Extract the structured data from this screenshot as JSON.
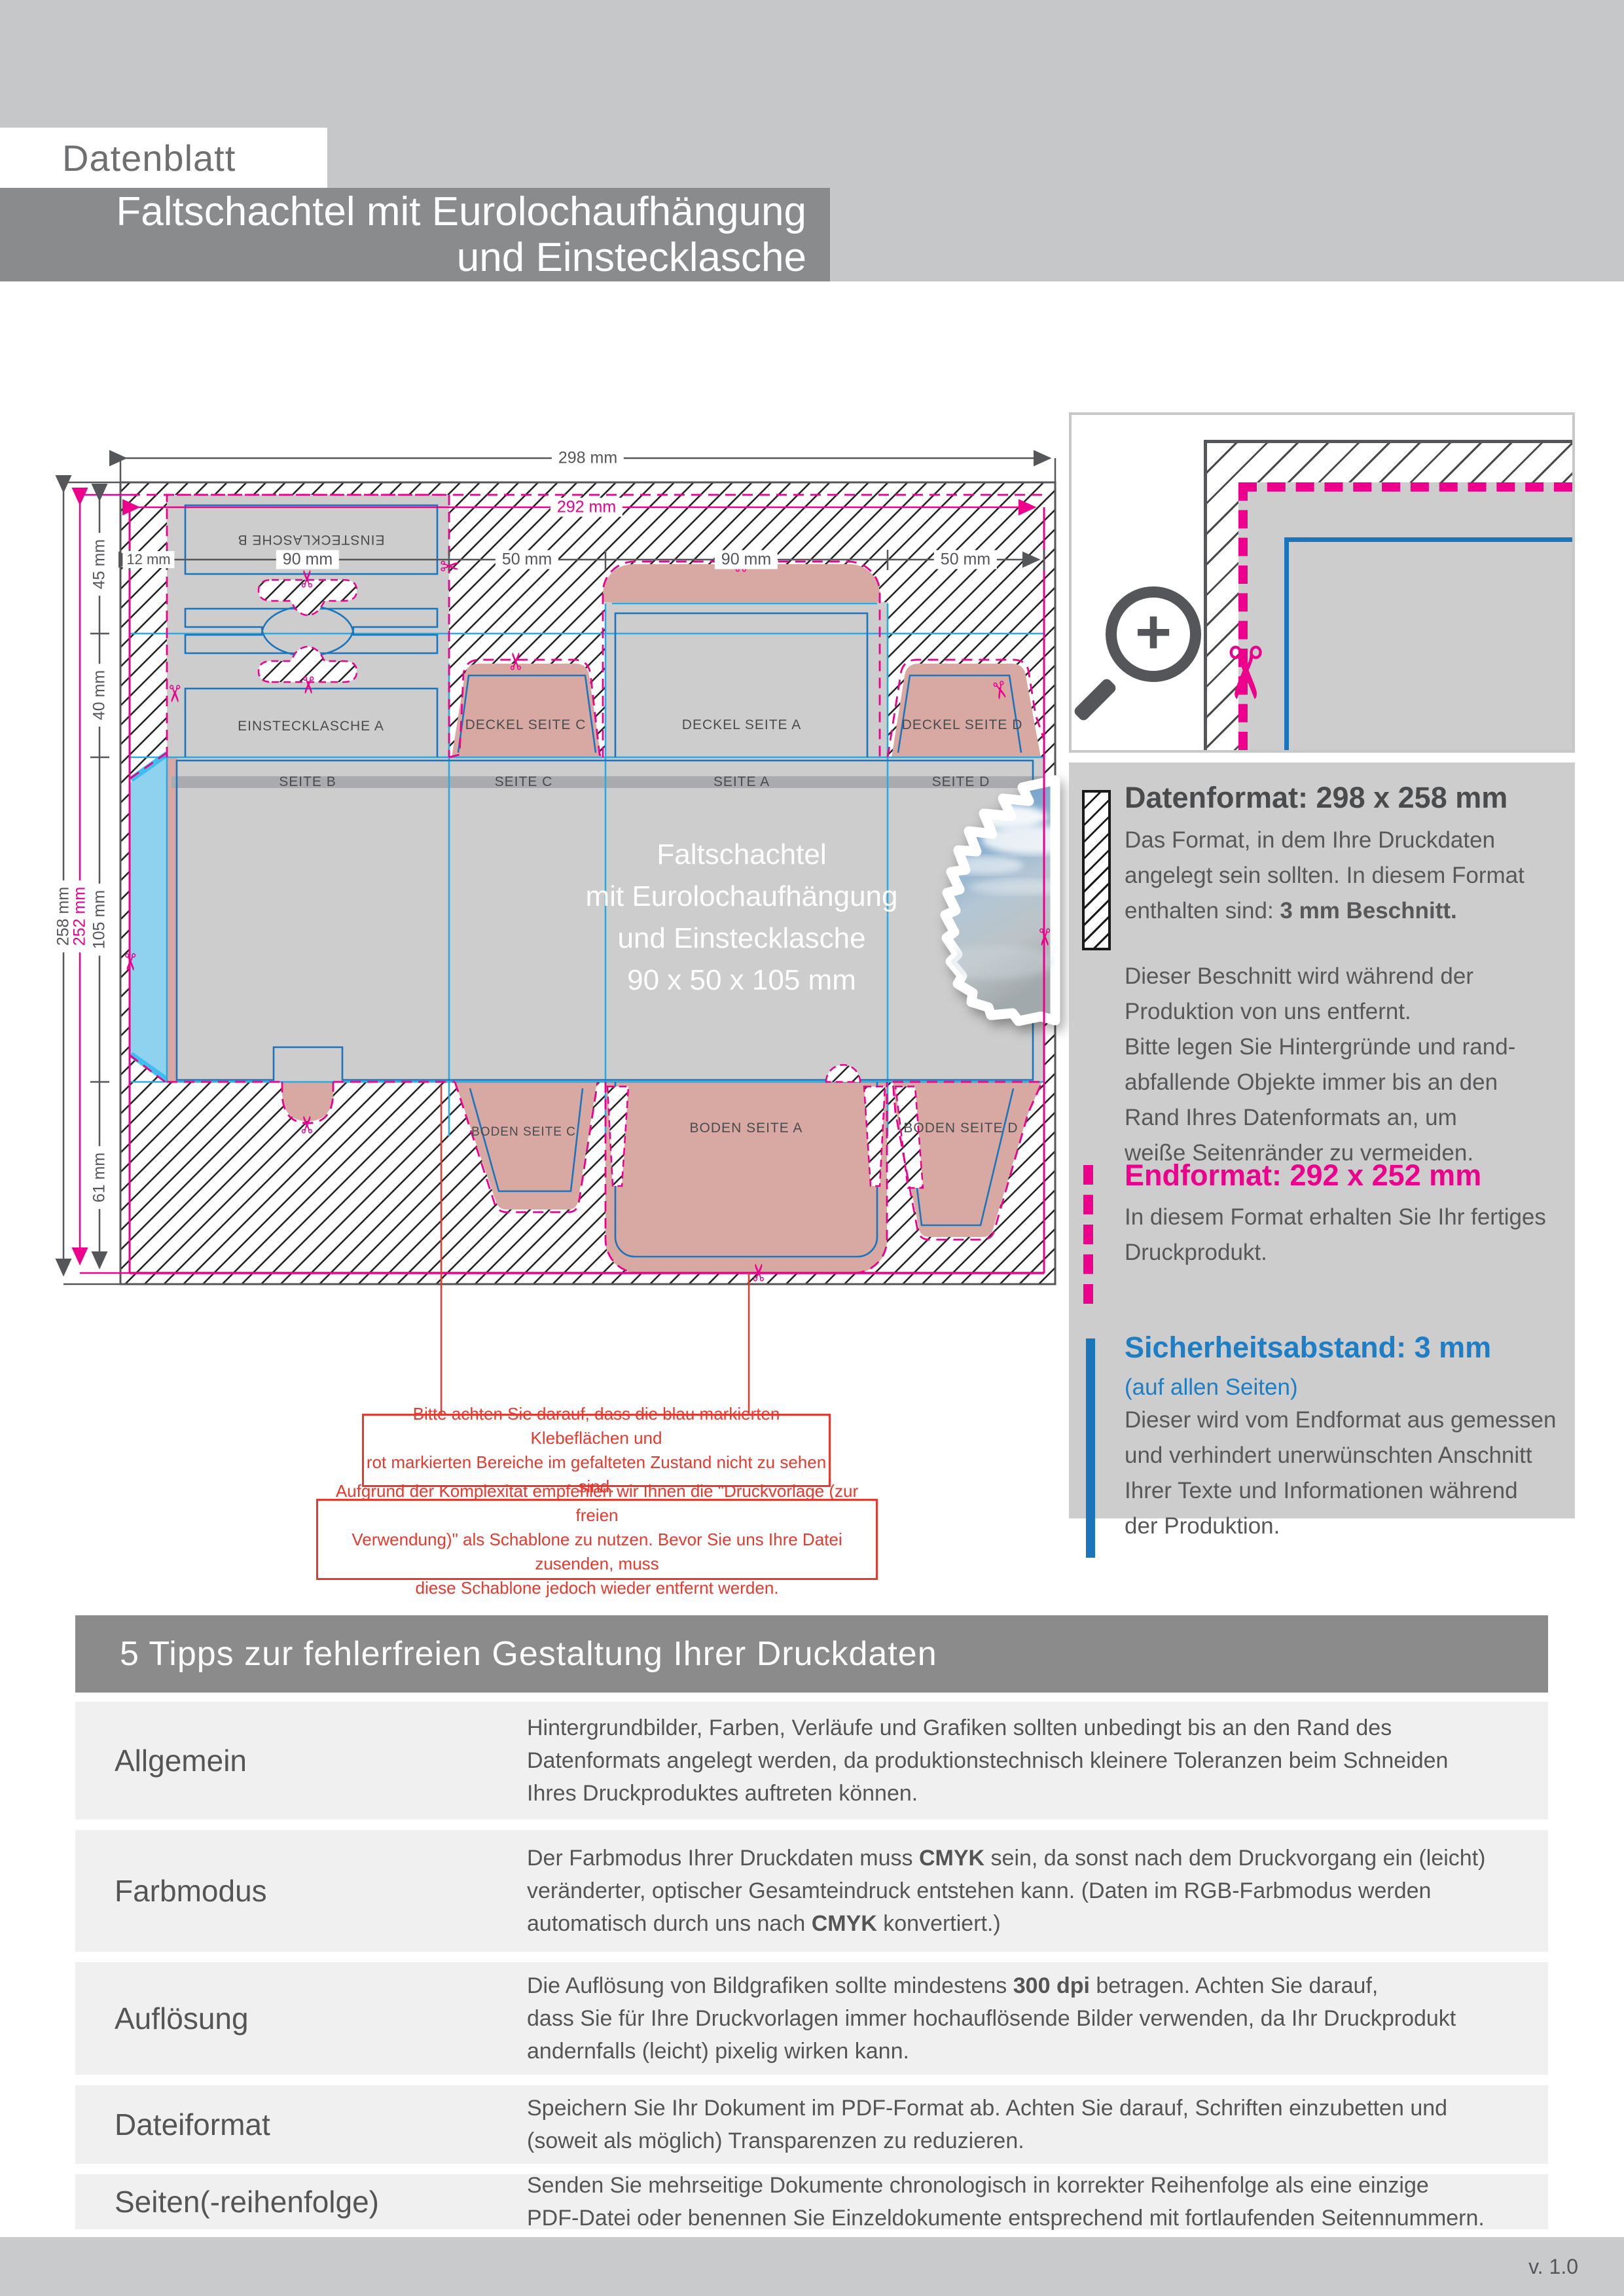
{
  "header": {
    "sheet_label": "Datenblatt",
    "title": "Faltschachtel mit Eurolochaufhängung\nund Einstecklasche"
  },
  "diagram": {
    "dims_top": {
      "outer": "298 mm",
      "inner": "292 mm",
      "segments": [
        "12 mm",
        "90 mm",
        "50 mm",
        "90 mm",
        "50 mm"
      ]
    },
    "dims_left": {
      "outer": "258 mm",
      "inner": "252 mm",
      "segments": [
        "45 mm",
        "40 mm",
        "105 mm",
        "61 mm"
      ]
    },
    "panels": {
      "einstecklasche_b": "EINSTECKLASCHE B",
      "einstecklasche_a": "EINSTECKLASCHE A",
      "deckel_c": "DECKEL SEITE C",
      "deckel_a": "DECKEL SEITE A",
      "deckel_d": "DECKEL SEITE D",
      "seite_b": "SEITE B",
      "seite_c": "SEITE C",
      "seite_a": "SEITE A",
      "seite_d": "SEITE D",
      "boden_c": "BODEN SEITE C",
      "boden_a": "BODEN SEITE A",
      "boden_d": "BODEN SEITE D"
    },
    "product_text": "Faltschachtel\nmit Eurolochaufhängung\nund Einstecklasche\n90 x 50 x 105 mm"
  },
  "notes": {
    "note1": "Bitte achten Sie darauf, dass die blau markierten Klebeflächen und\nrot markierten Bereiche im gefalteten Zustand nicht zu sehen sind.",
    "note2": "Aufgrund der Komplexität empfehlen wir Ihnen die \"Druckvorlage (zur freien\nVerwendung)\" als Schablone zu nutzen. Bevor Sie uns Ihre Datei zusenden, muss\ndiese Schablone jedoch wieder entfernt werden."
  },
  "info": {
    "datenformat_title": "Datenformat: 298 x 258 mm",
    "datenformat_body": "Das Format, in dem Ihre Druckdaten\nangelegt sein sollten. In diesem Format\n enthalten sind: **3 mm Beschnitt.**",
    "bleed_note": "Dieser Beschnitt wird während der\nProduktion von uns entfernt.\nBitte legen Sie Hintergründe und rand-\nabfallende Objekte immer bis an den\nRand Ihres Datenformats an, um\nweiße Seitenränder zu vermeiden.",
    "endformat_title": "Endformat: 292 x 252 mm",
    "endformat_body": "In diesem Format erhalten Sie Ihr fertiges\nDruckprodukt.",
    "safety_title": "Sicherheitsabstand: 3 mm",
    "safety_sub": "(auf allen Seiten)",
    "safety_body": "Dieser wird vom Endformat aus gemessen\nund verhindert unerwünschten Anschnitt\nIhrer Texte und Informationen während\nder Produktion."
  },
  "tips": {
    "header": "5 Tipps zur fehlerfreien Gestaltung Ihrer Druckdaten",
    "rows": [
      {
        "label": "Allgemein",
        "text": "Hintergrundbilder, Farben, Verläufe und Grafiken sollten unbedingt bis an den Rand des\nDatenformats angelegt werden, da produktionstechnisch kleinere Toleranzen beim Schneiden\nIhres Druckproduktes auftreten können."
      },
      {
        "label": "Farbmodus",
        "text": "Der Farbmodus Ihrer Druckdaten muss **CMYK** sein, da sonst nach dem Druckvorgang ein (leicht)\nveränderter, optischer Gesamteindruck entstehen kann. (Daten im RGB-Farbmodus werden\nautomatisch durch uns nach **CMYK** konvertiert.)"
      },
      {
        "label": "Auflösung",
        "text": "Die Auflösung von Bildgrafiken sollte mindestens **300 dpi** betragen. Achten Sie darauf,\ndass Sie für Ihre Druckvorlagen immer hochauflösende Bilder verwenden, da Ihr Druckprodukt\nandernfalls (leicht) pixelig wirken kann."
      },
      {
        "label": "Dateiformat",
        "text": "Speichern Sie Ihr Dokument im PDF-Format ab. Achten Sie darauf, Schriften einzubetten und\n(soweit als möglich) Transparenzen zu reduzieren."
      },
      {
        "label": "Seiten(-reihenfolge)",
        "text": "Senden Sie mehrseitige Dokumente chronologisch in korrekter Reihenfolge als eine einzige\nPDF-Datei oder benennen Sie Einzeldokumente entsprechend mit fortlaufenden Seitennummern."
      }
    ]
  },
  "footer": {
    "version": "v. 1.0"
  },
  "colors": {
    "magenta": "#ec008c",
    "dieline_blue": "#1b75bc",
    "fold_cyan": "#29abe2",
    "note_red": "#e8392f",
    "panel_rose": "#d8a8a2",
    "panel_gray": "#cdcdcd",
    "glue_cyan": "#8ed2f0",
    "text_gray": "#55565a"
  }
}
